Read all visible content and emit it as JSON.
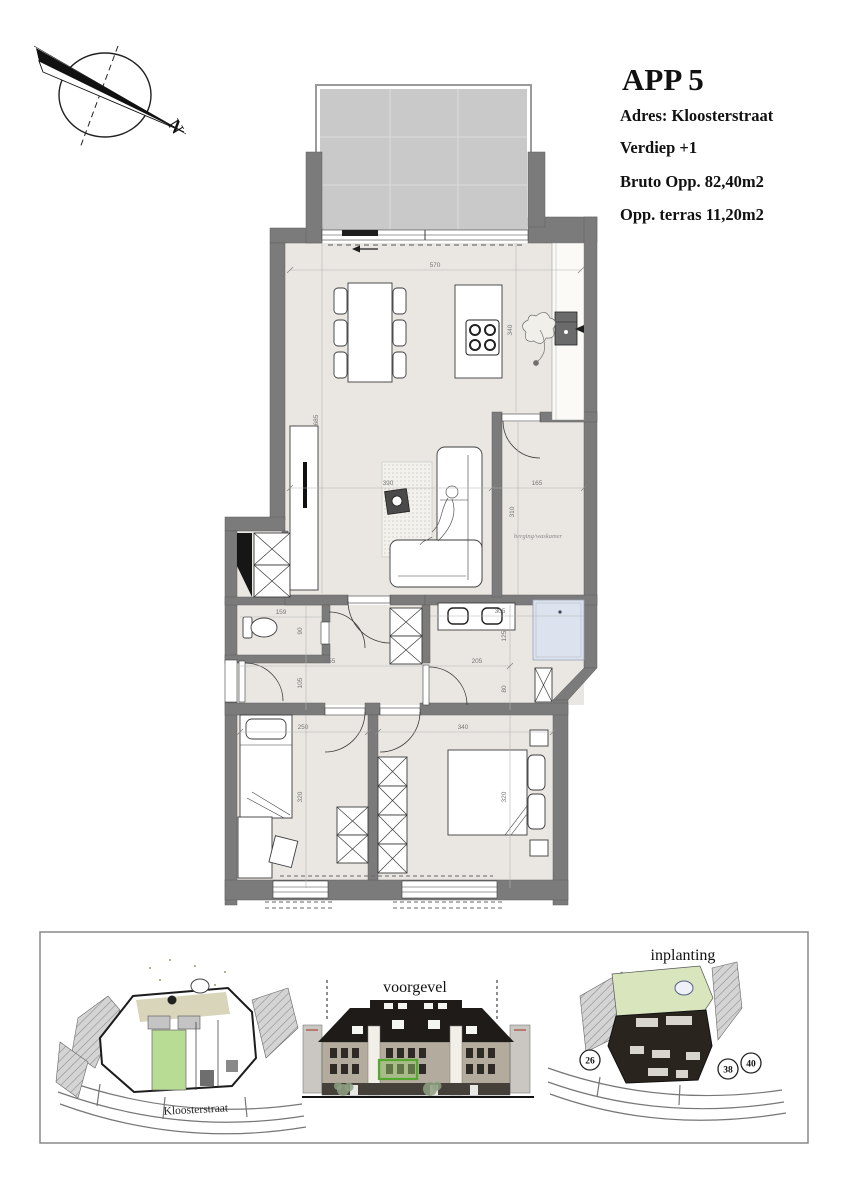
{
  "header": {
    "title": "APP 5",
    "lines": [
      "Adres: Kloosterstraat",
      "Verdiep +1",
      "Bruto Opp. 82,40m2",
      "Opp. terras 11,20m2"
    ]
  },
  "compass": {
    "north_label": "N"
  },
  "plan": {
    "room_labels": {
      "berging": "berging/waskamer"
    },
    "dims": {
      "living_width": "570",
      "kitchen_depth": "340",
      "living_height": "685",
      "tv_wall": "390",
      "berging_width": "165",
      "berging_depth": "310",
      "wc_width": "159",
      "wc_depth": "90",
      "hall_width": "355",
      "hall_depth": "105",
      "vanity_width": "305",
      "bath_depth_a": "125",
      "bath_width": "205",
      "bath_depth_b": "80",
      "bedroom2_width": "250",
      "bedroom2_depth": "320",
      "bedroom1_width": "340",
      "bedroom1_depth": "320"
    }
  },
  "site_panel": {
    "voorgevel_label": "voorgevel",
    "inplanting_label": "inplanting",
    "street_label": "Kloosterstraat",
    "house_numbers": [
      "26",
      "38",
      "40"
    ]
  },
  "colors": {
    "wall_gray": "#7b7b7b",
    "floor_beige": "#eae7e2",
    "terrace_gray": "#c9c9c9",
    "shower_blue": "#dce3ee",
    "unit_green": "#b9dc94",
    "garden_green": "#d8e5bd",
    "highlight_green": "#55a82f"
  }
}
